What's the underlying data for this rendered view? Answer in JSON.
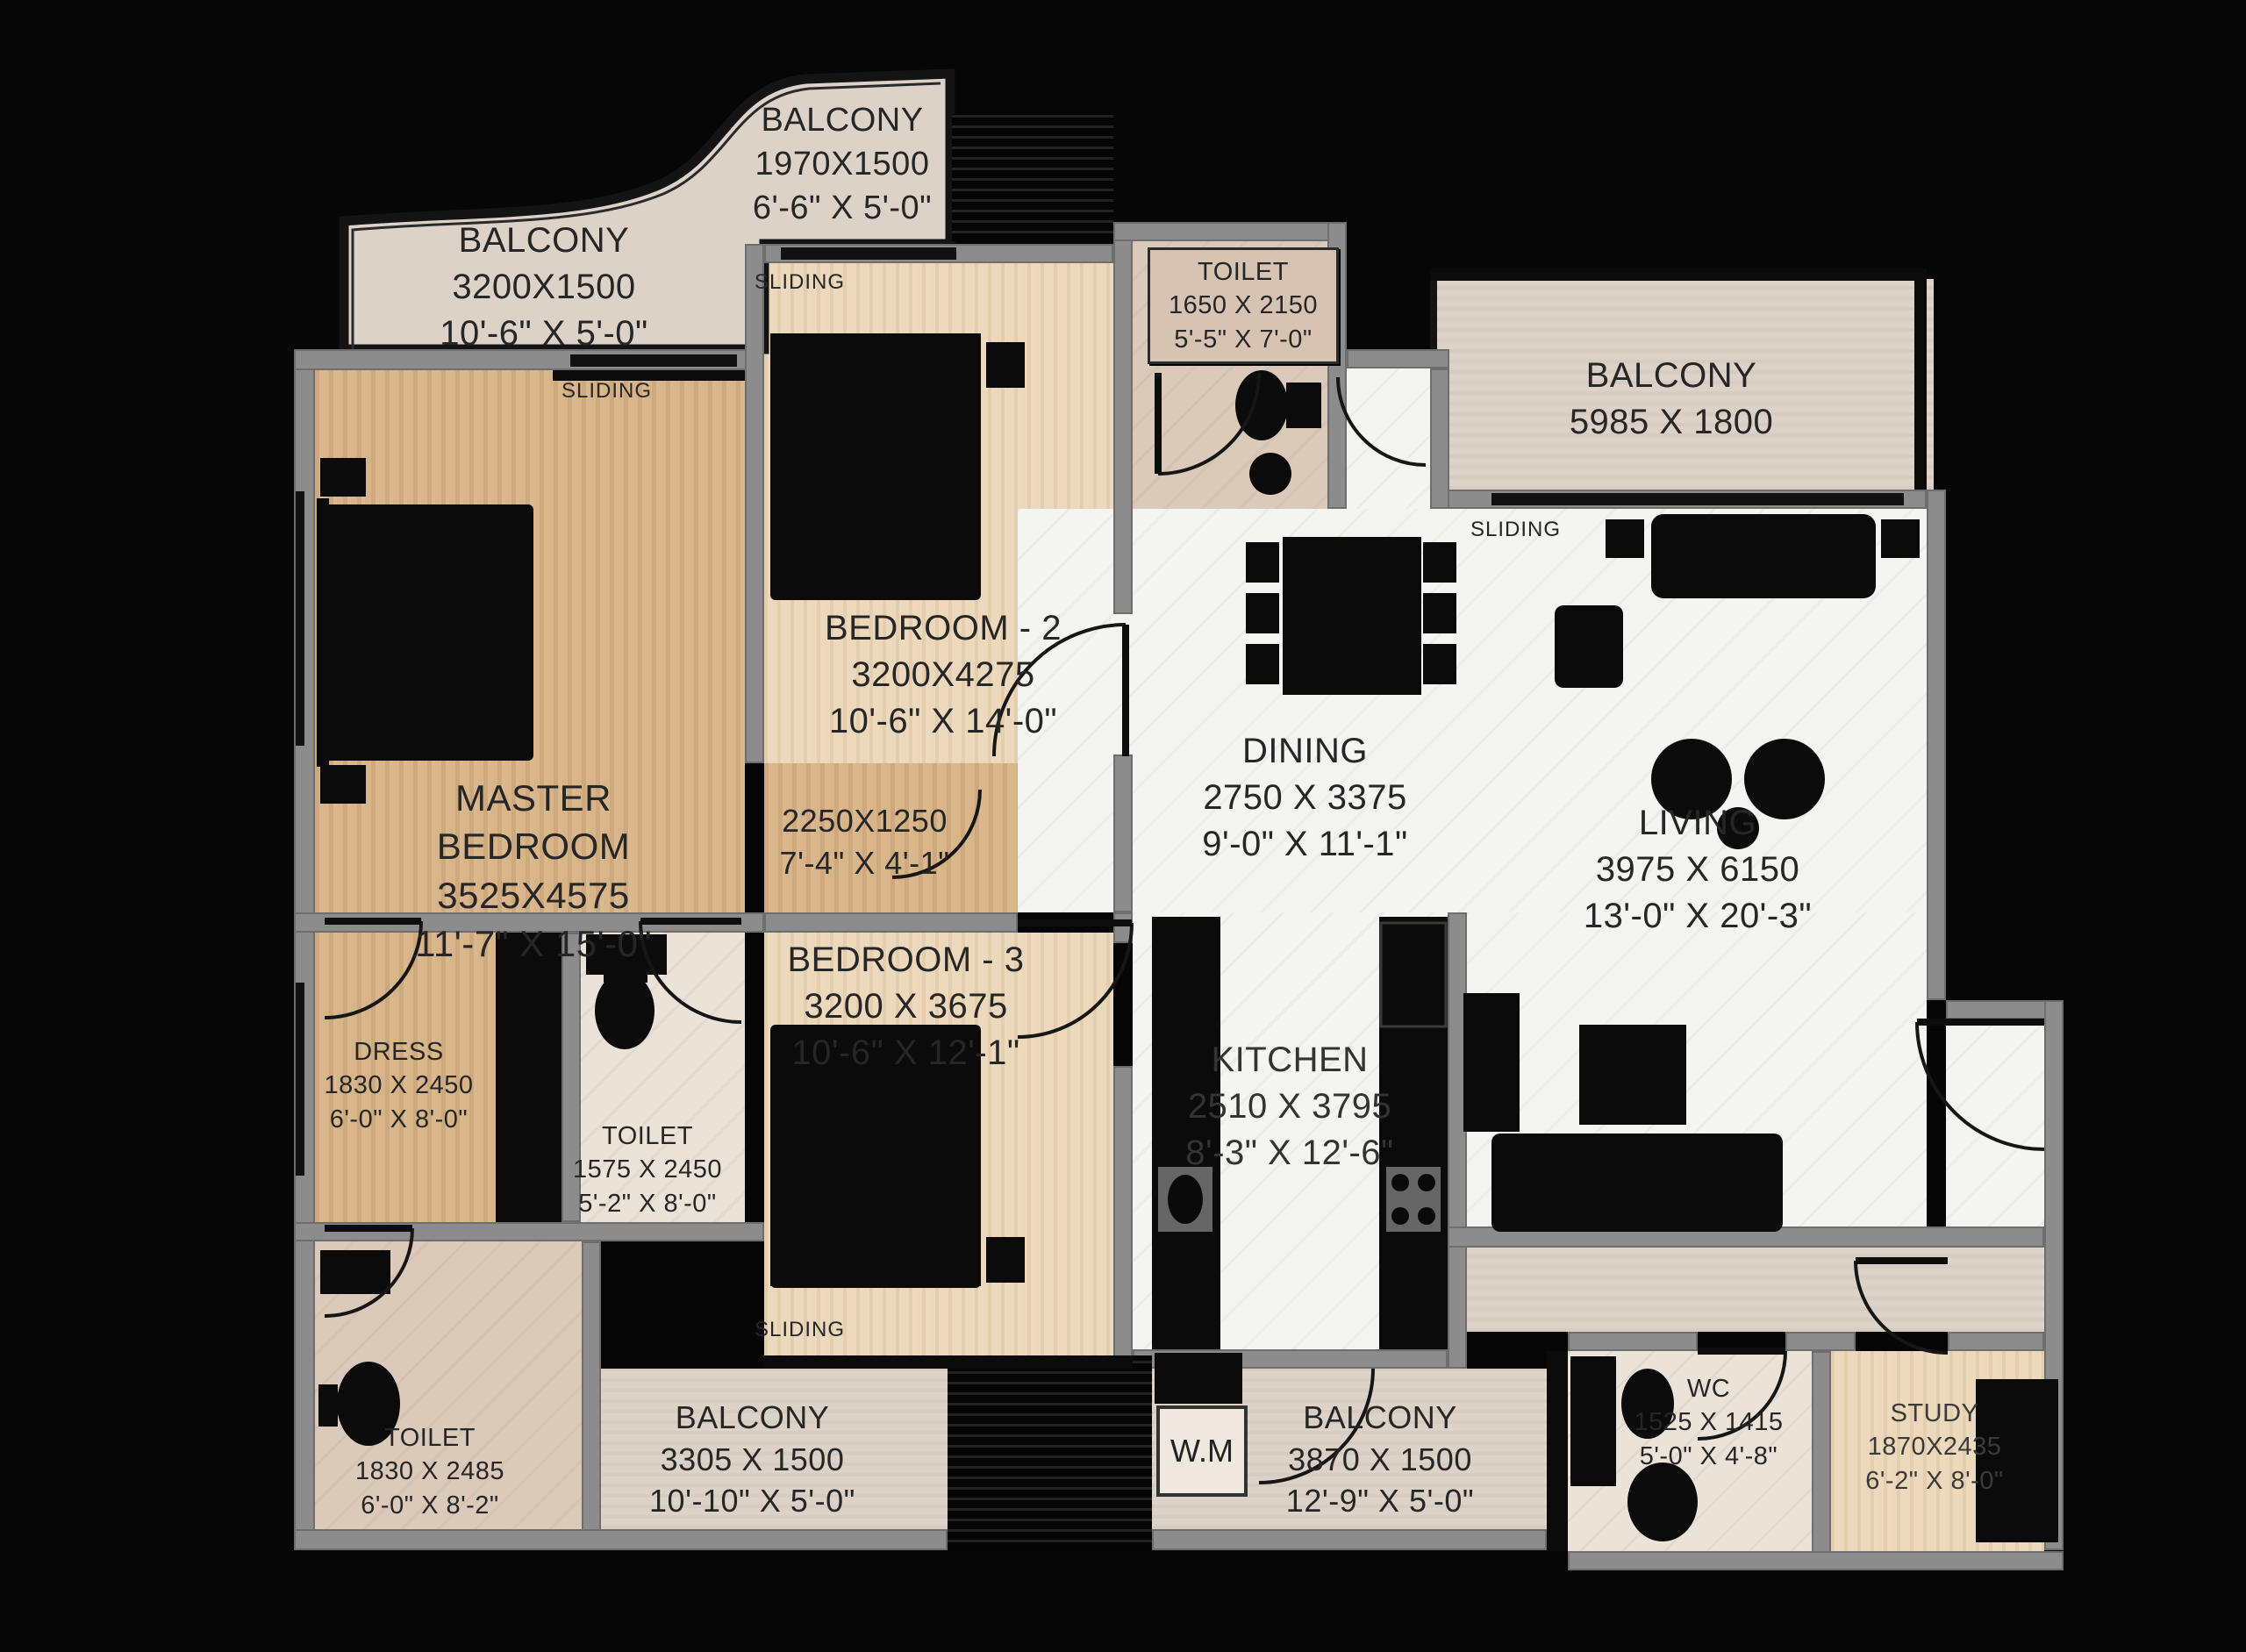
{
  "plan": {
    "title": "3 BHK + Study Apartment Floor Plan",
    "rooms": {
      "balcony_top": {
        "name": "BALCONY",
        "mm": "1970X1500",
        "ft": "6'-6\" X 5'-0\""
      },
      "balcony_top_left": {
        "name": "BALCONY",
        "mm": "3200X1500",
        "ft": "10'-6\" X 5'-0\""
      },
      "toilet_top": {
        "name": "TOILET",
        "mm": "1650 X 2150",
        "ft": "5'-5\" X 7'-0\""
      },
      "balcony_right": {
        "name": "BALCONY",
        "mm": "5985 X 1800"
      },
      "bedroom2": {
        "name": "BEDROOM - 2",
        "mm": "3200X4275",
        "ft": "10'-6\" X 14'-0\""
      },
      "master": {
        "name": "MASTER BEDROOM",
        "mm": "3525X4575",
        "ft": "11'-7\" X 15'-0\""
      },
      "passage": {
        "mm": "2250X1250",
        "ft": "7'-4\" X 4'-1\""
      },
      "dining": {
        "name": "DINING",
        "mm": "2750 X 3375",
        "ft": "9'-0\" X 11'-1\""
      },
      "living": {
        "name": "LIVING",
        "mm": "3975 X 6150",
        "ft": "13'-0\" X 20'-3\""
      },
      "bedroom3": {
        "name": "BEDROOM - 3",
        "mm": "3200 X 3675",
        "ft": "10'-6\" X 12'-1\""
      },
      "dress": {
        "name": "DRESS",
        "mm": "1830 X 2450",
        "ft": "6'-0\" X 8'-0\""
      },
      "toilet_mid": {
        "name": "TOILET",
        "mm": "1575 X 2450",
        "ft": "5'-2\" X 8'-0\""
      },
      "kitchen": {
        "name": "KITCHEN",
        "mm": "2510 X 3795",
        "ft": "8'-3\" X 12'-6\""
      },
      "toilet_bl": {
        "name": "TOILET",
        "mm": "1830 X 2485",
        "ft": "6'-0\" X 8'-2\""
      },
      "balcony_bl": {
        "name": "BALCONY",
        "mm": "3305 X 1500",
        "ft": "10'-10\" X 5'-0\""
      },
      "balcony_bm": {
        "name": "BALCONY",
        "mm": "3870 X 1500",
        "ft": "12'-9\" X 5'-0\""
      },
      "wc": {
        "name": "WC",
        "mm": "1525 X 1415",
        "ft": "5'-0\" X 4'-8\""
      },
      "study": {
        "name": "STUDY",
        "mm": "1870X2435",
        "ft": "6'-2\" X 8'-0\""
      },
      "wm": {
        "name": "W.M"
      }
    },
    "annotations": {
      "sliding": "SLIDING"
    },
    "colors": {
      "background": "#060606",
      "wall": "#8c8c8c",
      "wood_master": "#d8b489",
      "wood_bedroom": "#ecd8ba",
      "marble": "#f4f4f1",
      "balcony": "#ddd2c7",
      "furniture": "#0b0b0b",
      "text": "#262626"
    }
  }
}
